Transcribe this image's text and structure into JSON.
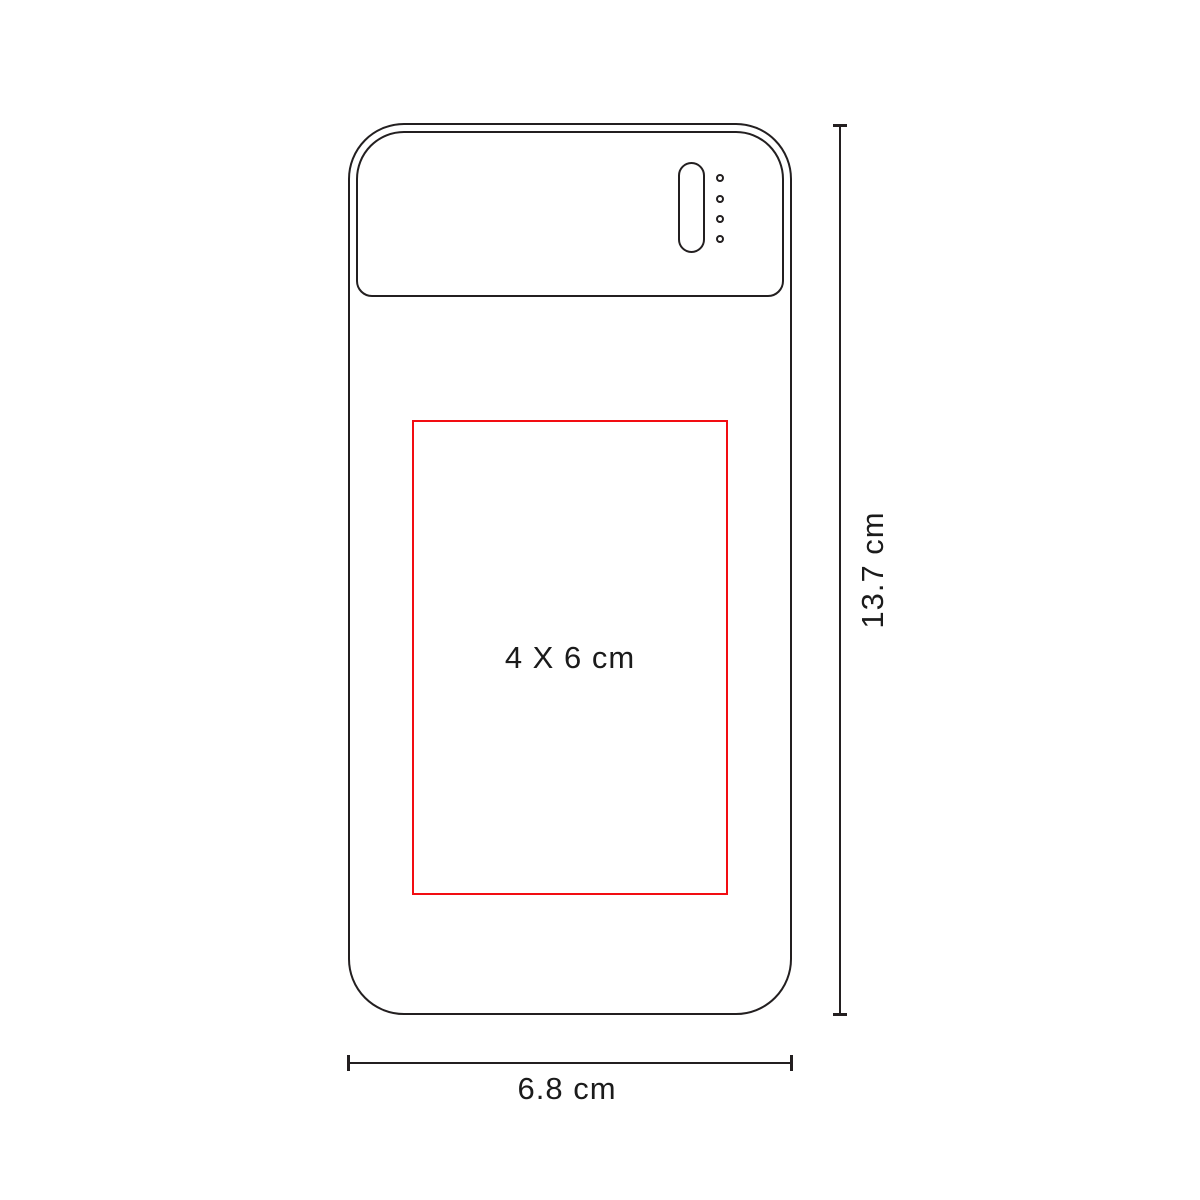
{
  "diagram": {
    "type": "product-print-area-dimension-drawing",
    "device": "power-bank-rear-view-outline",
    "print_area": {
      "label": "4 X 6 cm"
    },
    "height_dimension": {
      "label": "13.7 cm"
    },
    "width_dimension": {
      "label": "6.8 cm"
    },
    "led_indicator": {
      "dot_count": 4
    },
    "colors": {
      "outline": "#231f20",
      "print_area": "#f20d12",
      "background": "#ffffff"
    }
  }
}
